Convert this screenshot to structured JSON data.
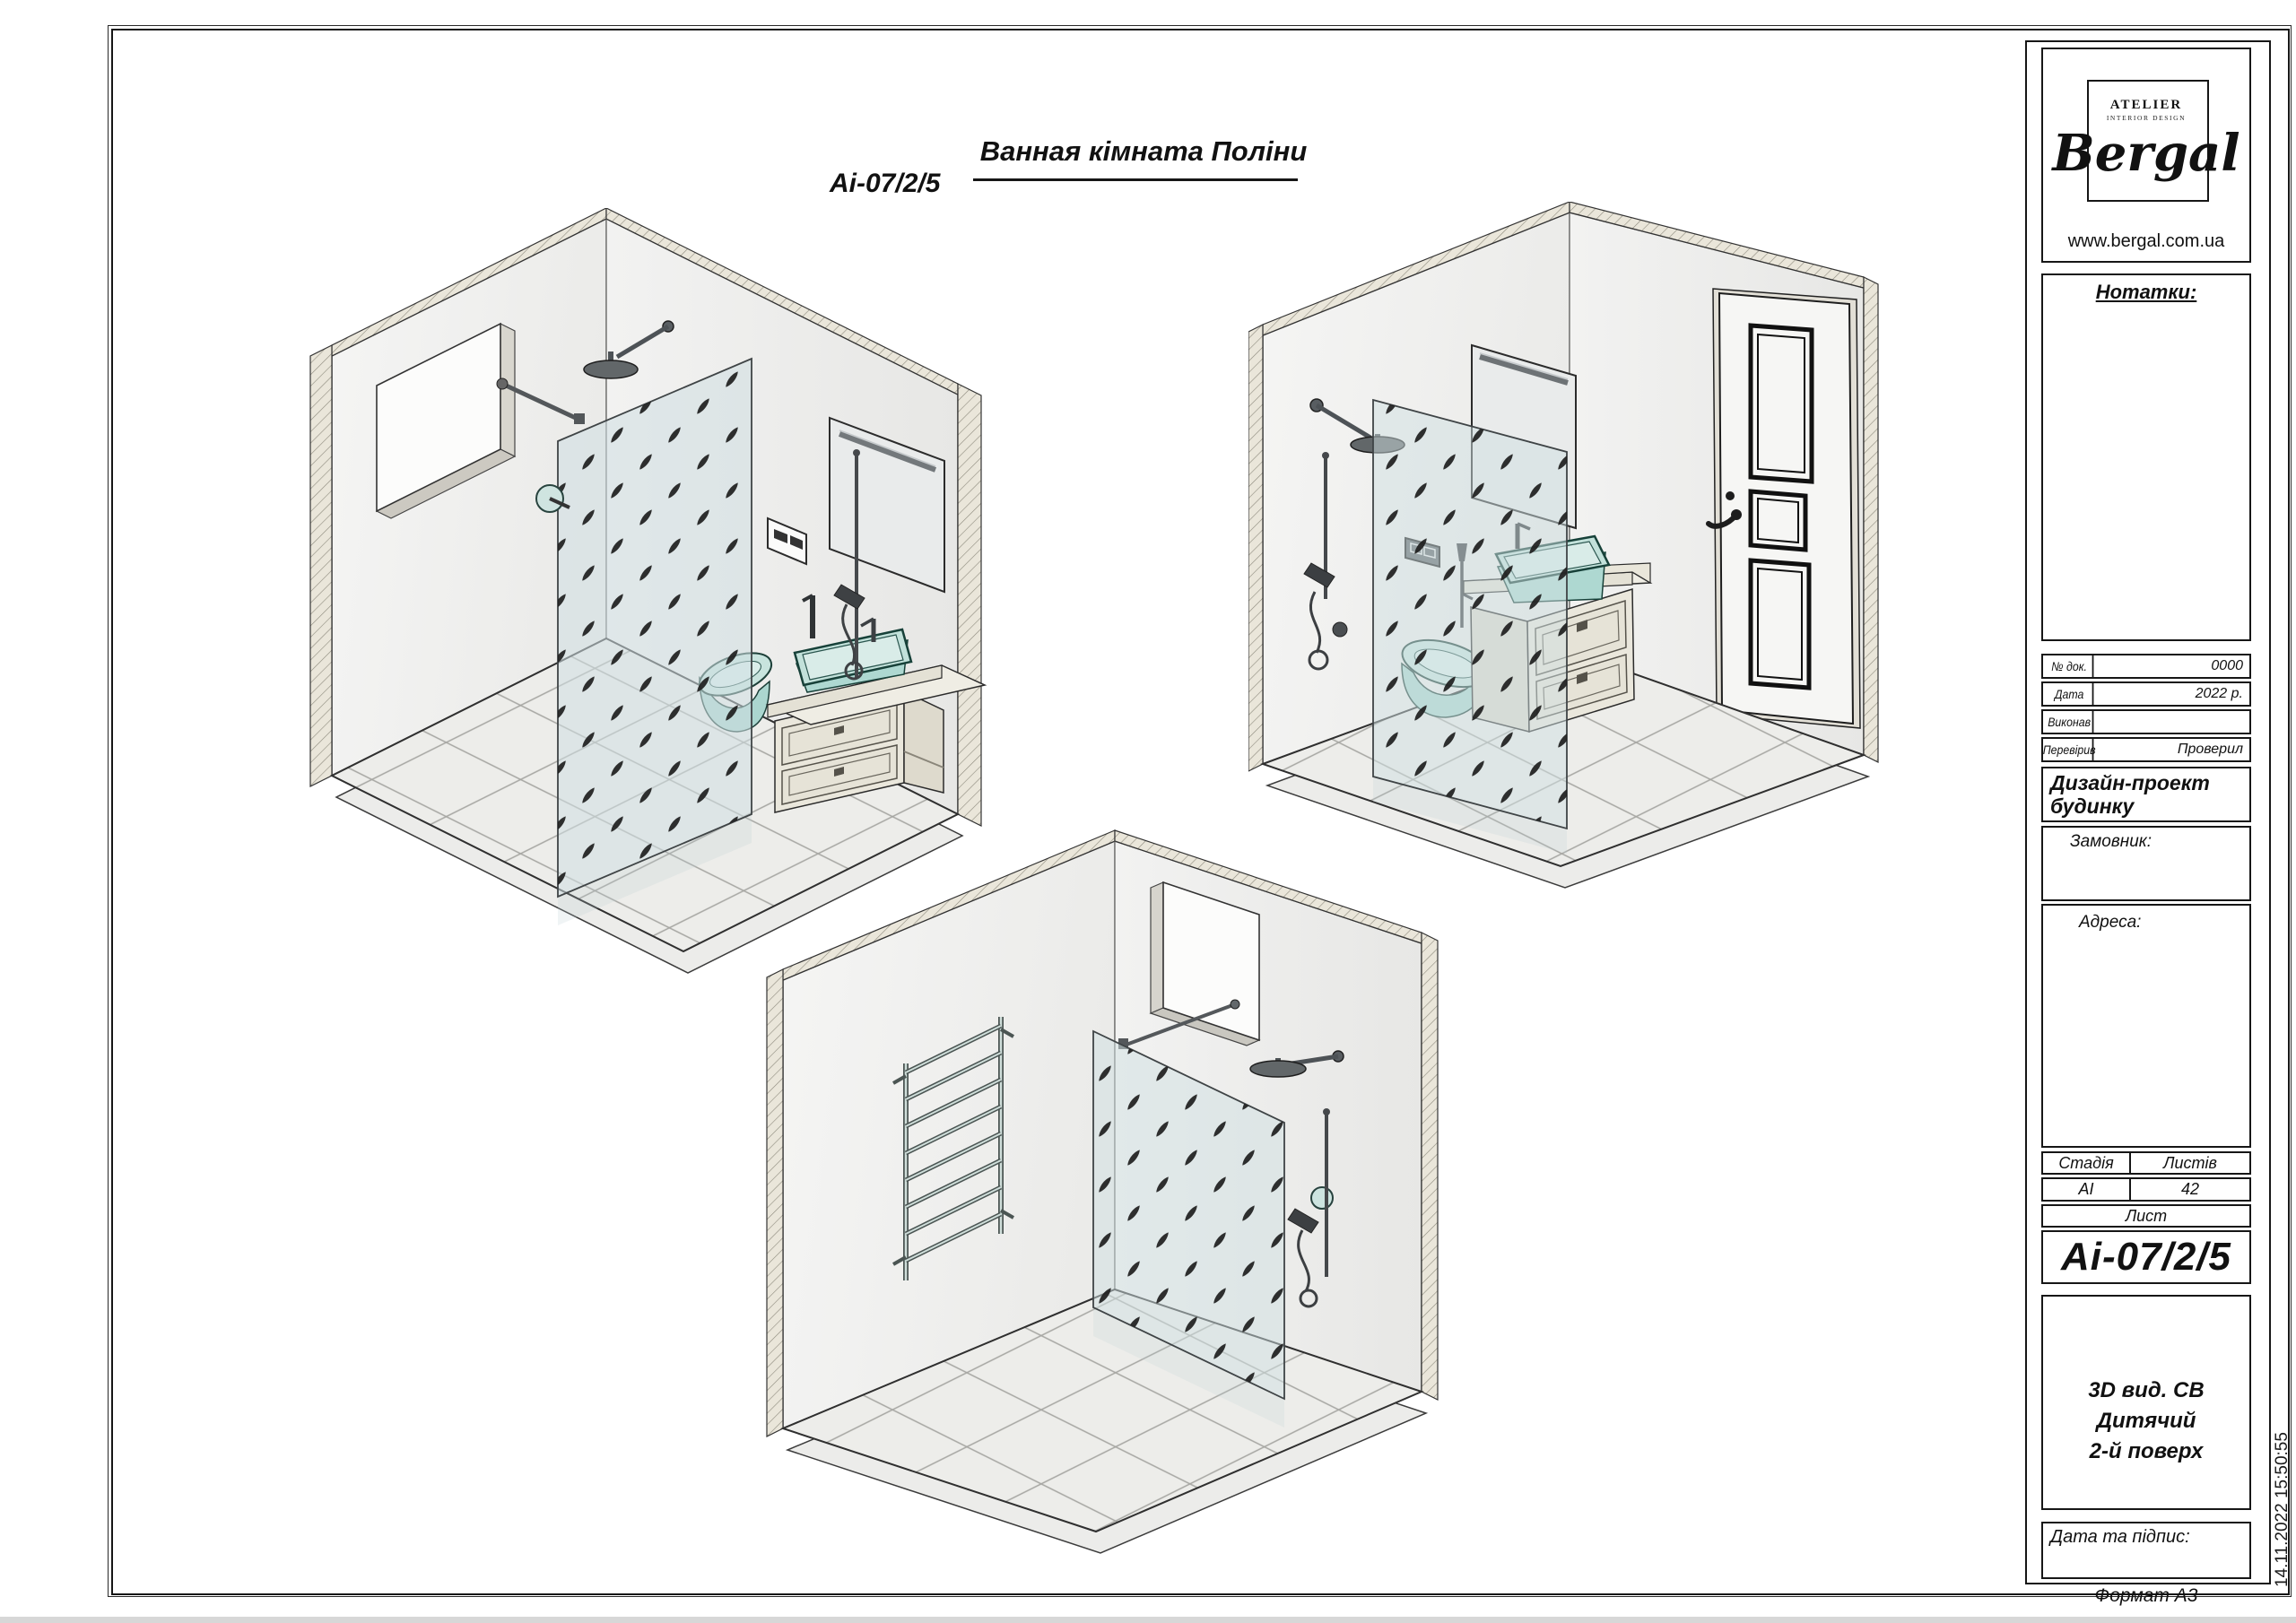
{
  "header": {
    "code": "Аі-07/2/5",
    "title": "Ванная кімната Поліни"
  },
  "brand": {
    "atelier": "ATELIER",
    "atelier_sub": "INTERIOR DESIGN",
    "name": "Bergal",
    "website": "www.bergal.com.ua"
  },
  "titleblock": {
    "notes_label": "Нотатки:",
    "doc_rows": [
      {
        "label": "№ док.",
        "value": "0000"
      },
      {
        "label": "Дата",
        "value": "2022 р."
      },
      {
        "label": "Виконав",
        "value": ""
      },
      {
        "label": "Перевірив",
        "value": "Проверил"
      }
    ],
    "project_title_line1": "Дизайн-проект",
    "project_title_line2": "будинку",
    "client_label": "Замовник:",
    "address_label": "Адреса:",
    "stage_label": "Стадія",
    "sheets_label": "Листів",
    "stage_value": "АІ",
    "sheets_value": "42",
    "sheet_label": "Лист",
    "sheet_code": "Аі-07/2/5",
    "view_title_line1": "3D вид.  СВ Дитячий",
    "view_title_line2": "2-й  поверх",
    "signature_label": "Дата та підпис:"
  },
  "footer": {
    "format_label": "Формат А3",
    "timestamp": "14.11.2022 15:50:55"
  },
  "colors": {
    "fixture_teal": "#aed6cf",
    "fixture_teal_light": "#d9ece8",
    "cabinet_cream": "#eae7dc",
    "glass_tint": "#cfdfe2",
    "wall_hatch_beige": "#eae6da",
    "line": "#1d1d1d"
  }
}
